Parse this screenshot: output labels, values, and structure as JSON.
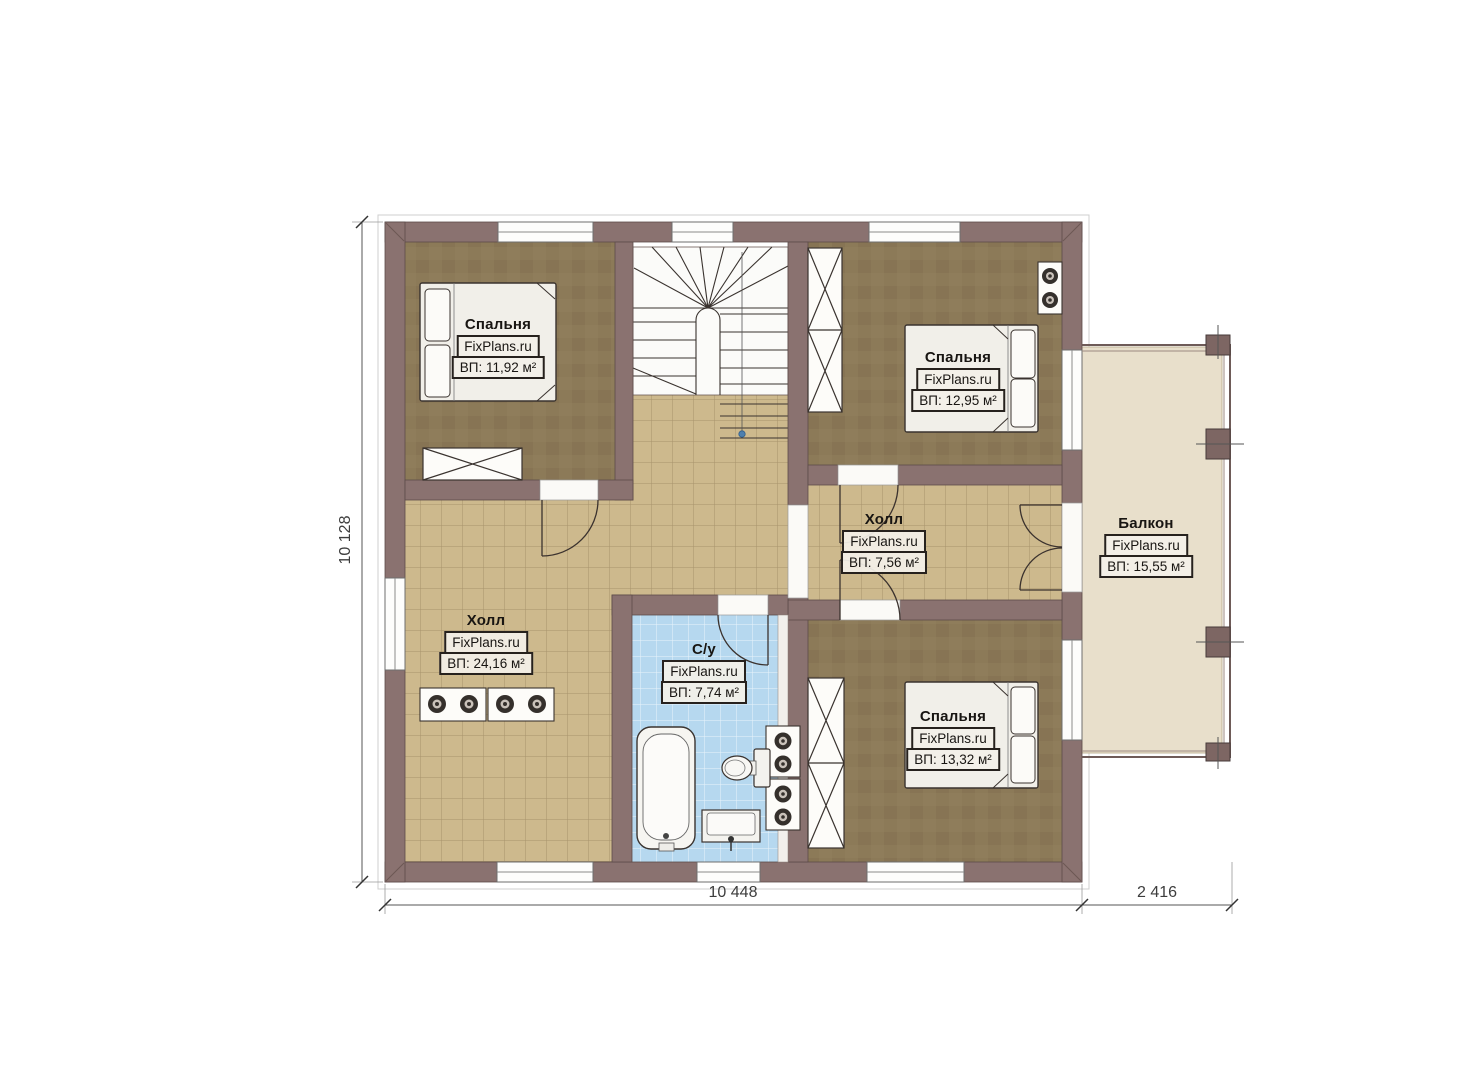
{
  "branding": {
    "watermark": "FixPlans.ru"
  },
  "rooms": [
    {
      "id": "bedroom-1",
      "name": "Спальня",
      "area": "ВП: 11,92 м²"
    },
    {
      "id": "bedroom-2",
      "name": "Спальня",
      "area": "ВП: 12,95 м²"
    },
    {
      "id": "hall-2",
      "name": "Холл",
      "area": "ВП: 7,56 м²"
    },
    {
      "id": "hall-1",
      "name": "Холл",
      "area": "ВП: 24,16 м²"
    },
    {
      "id": "bathroom",
      "name": "С/у",
      "area": "ВП: 7,74 м²"
    },
    {
      "id": "bedroom-3",
      "name": "Спальня",
      "area": "ВП: 13,32 м²"
    },
    {
      "id": "balcony",
      "name": "Балкон",
      "area": "ВП: 15,55 м²"
    }
  ],
  "dimensions": {
    "left": "10 128",
    "bottom_main": "10 448",
    "bottom_balcony": "2 416"
  },
  "colors": {
    "wall": "#8a7270",
    "bedroom_floor": "#897754",
    "tile_floor": "#cdb98d",
    "bath_floor": "#b6d8ef",
    "balcony_floor": "#e8dfcb"
  }
}
